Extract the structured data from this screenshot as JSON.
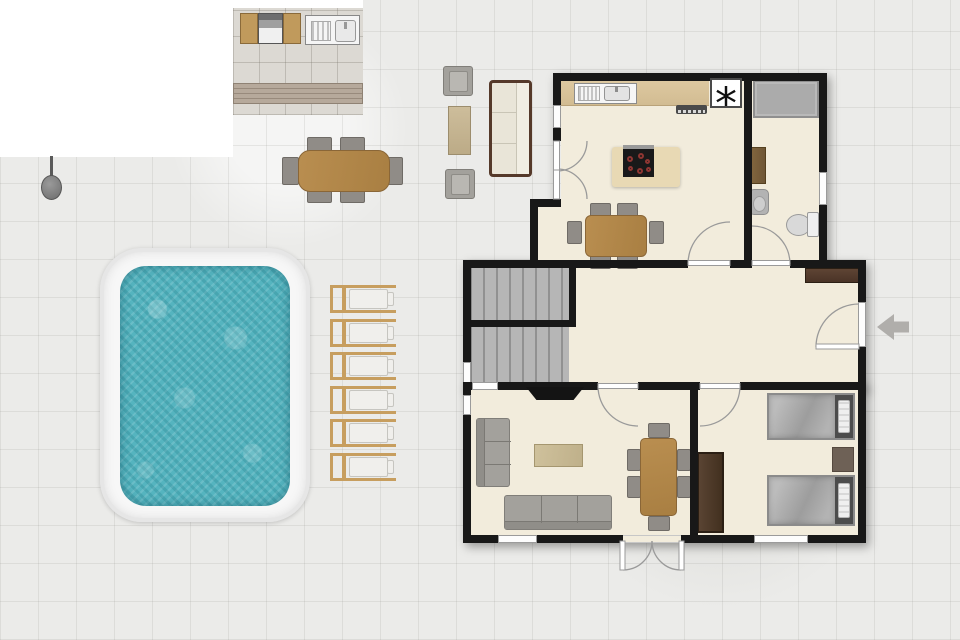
{
  "title": "Holiday villa floor plan with swimming pool",
  "symbols": {
    "fridge": "*"
  },
  "palette": {
    "wall": "#181818",
    "interior_floor": "#f2ecdc",
    "outdoor_tile": "#ebebe9",
    "patio_tile": "#dcd9d3",
    "wood_deck": "#a99c8e",
    "pool_water": "#55b4bf",
    "pool_deck": "#f7f7f7",
    "wood_furniture": "#b5894c",
    "chair_gray": "#908c87",
    "dark_brown_furniture": "#533d2c",
    "stairs_gray": "#b6b6b6",
    "shower_gray": "#ababab",
    "entry_arrow": "#b0aeab"
  },
  "outdoor": {
    "pool": {
      "label": "swimming-pool"
    },
    "sun_loungers": {
      "count": 6,
      "x": 330,
      "width": 66,
      "height": 28,
      "y_positions": [
        285,
        319,
        352,
        386,
        419,
        453
      ]
    },
    "shower": {
      "label": "outdoor-shower"
    },
    "bbq": {
      "label": "bbq-grill"
    },
    "outdoor_sink": {
      "label": "outdoor-sink-unit"
    },
    "deck": {
      "label": "wood-deck-strip"
    },
    "dining_set": {
      "label": "outdoor-dining-table",
      "seats": 6
    },
    "lounge_set": {
      "label": "outdoor-lounge",
      "armchairs": 2,
      "sofas": 1,
      "coffee_tables": 1
    }
  },
  "house": {
    "rooms": [
      {
        "id": "kitchen-dining",
        "furniture": [
          "counter",
          "sink",
          "fridge",
          "extractor-hood",
          "island-cooktop",
          "dining-table-6-seats"
        ]
      },
      {
        "id": "bathroom",
        "furniture": [
          "shower",
          "bath-mat",
          "washbasin",
          "toilet"
        ]
      },
      {
        "id": "hallway",
        "furniture": [
          "staircase-two-flights",
          "console-sideboard",
          "entry-door"
        ]
      },
      {
        "id": "living-room",
        "furniture": [
          "tv",
          "sofa-left",
          "sofa-bottom",
          "coffee-table",
          "dining-table-6-seats"
        ]
      },
      {
        "id": "bedroom",
        "furniture": [
          "single-bed",
          "single-bed",
          "nightstand",
          "wardrobe"
        ]
      }
    ],
    "entry_arrow": {
      "direction": "left"
    },
    "stairs": {
      "flights": 2
    },
    "cooktop": {
      "burners": 6
    }
  }
}
